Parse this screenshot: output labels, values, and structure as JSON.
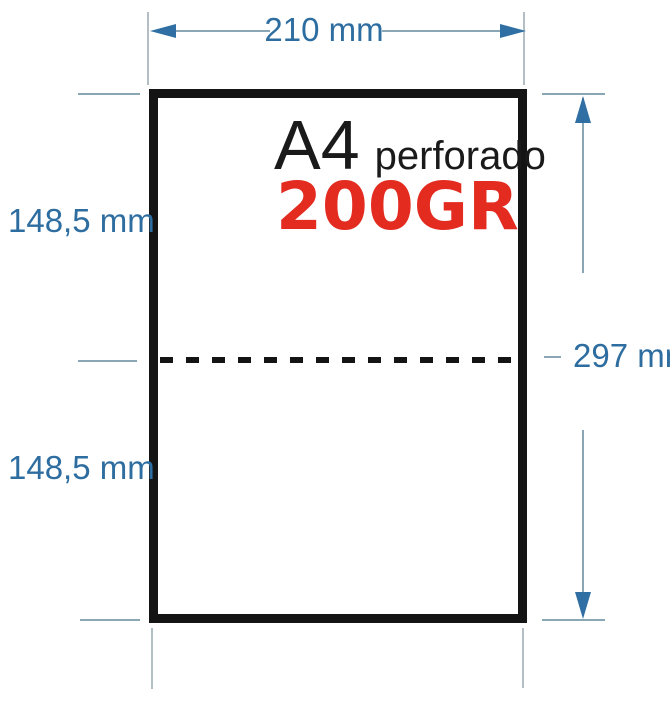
{
  "diagram": {
    "paper": {
      "format": "A4",
      "descriptor": "perforado",
      "weight": "200GR"
    },
    "dimensions": {
      "width_label": "210 mm",
      "height_label": "297 mm",
      "upper_half_label": "148,5 mm",
      "lower_half_label": "148,5 mm"
    },
    "colors": {
      "dim_text": "#2e6da0",
      "dim_line": "#8aa7b5",
      "ext_line": "#b3bfc4",
      "arrow": "#2f6fa3",
      "paper_border": "#141414",
      "weight_red": "#e32b20",
      "background": "#ffffff"
    }
  }
}
